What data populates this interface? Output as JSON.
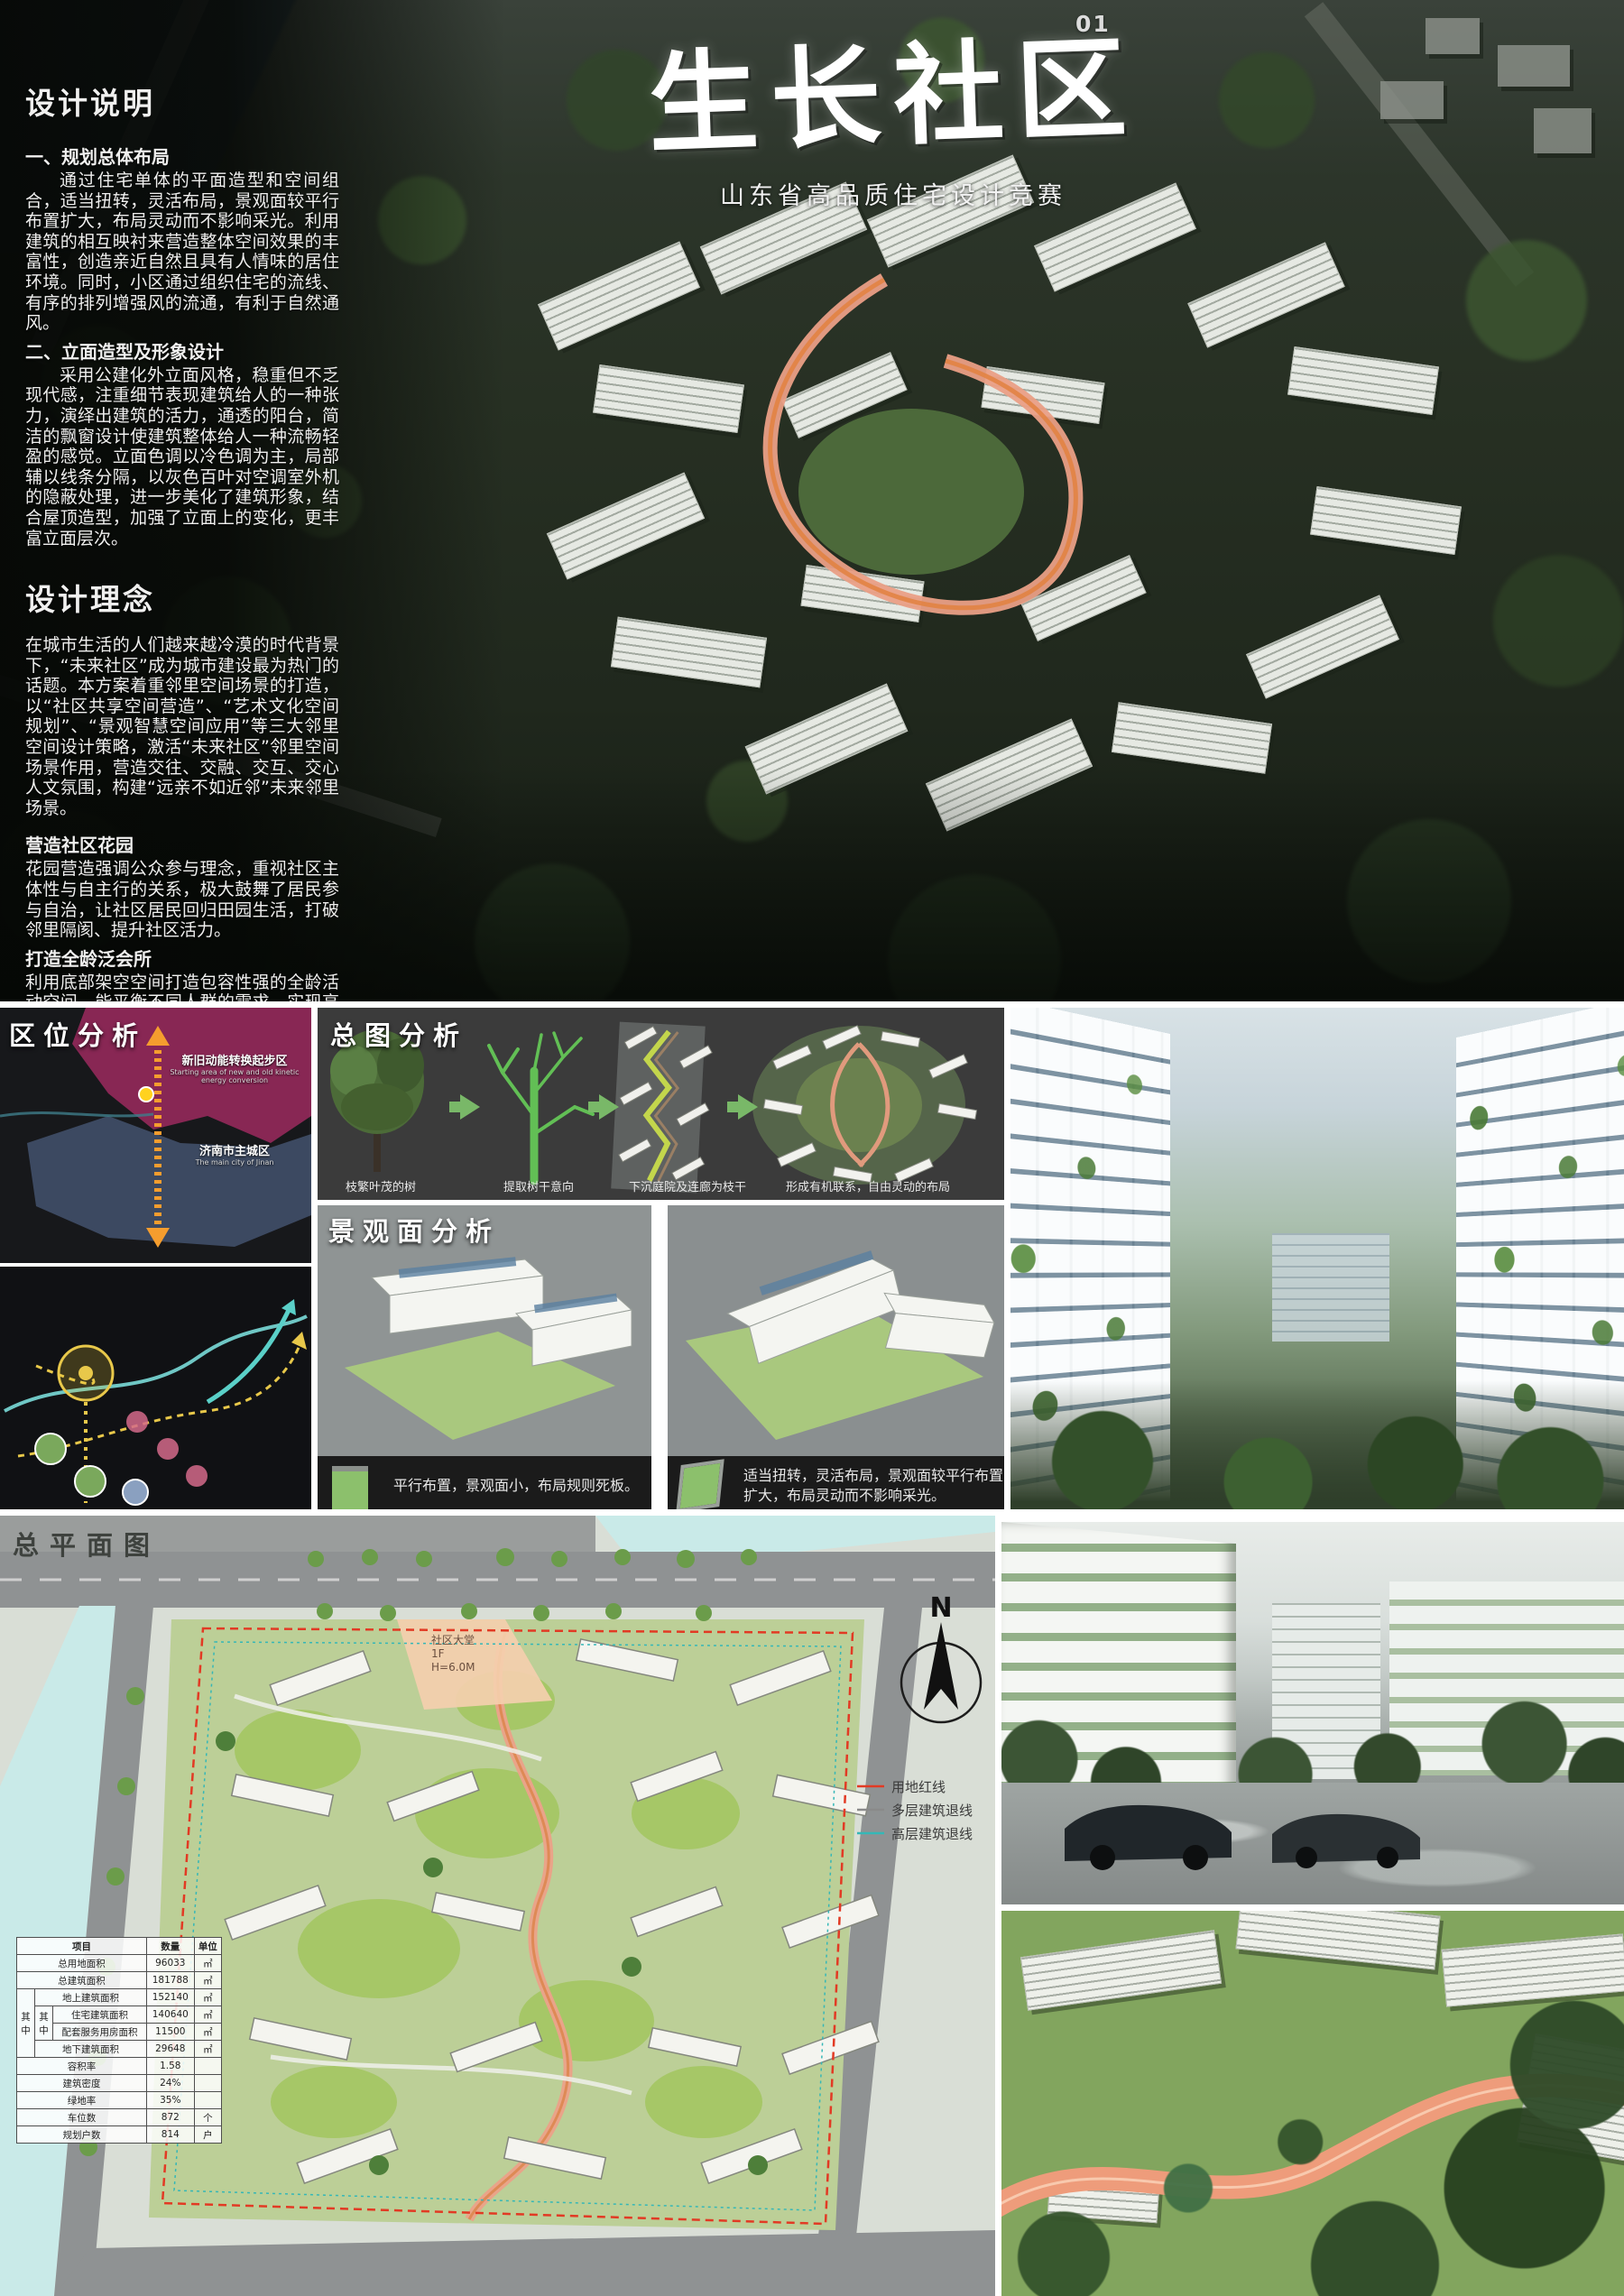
{
  "page": {
    "number": "01",
    "title": "生长社区",
    "subtitle": "山东省高品质住宅设计竞赛"
  },
  "design_notes": {
    "heading": "设计说明",
    "section1_title": "一、规划总体布局",
    "section1_body": "通过住宅单体的平面造型和空间组合，适当扭转，灵活布局，景观面较平行布置扩大，布局灵动而不影响采光。利用建筑的相互映衬来营造整体空间效果的丰富性，创造亲近自然且具有人情味的居住环境。同时，小区通过组织住宅的流线、有序的排列增强风的流通，有利于自然通风。",
    "section2_title": "二、立面造型及形象设计",
    "section2_body": "采用公建化外立面风格，稳重但不乏现代感，注重细节表现建筑给人的一种张力，演绎出建筑的活力，通透的阳台，简洁的飘窗设计使建筑整体给人一种流畅轻盈的感觉。立面色调以冷色调为主，局部辅以线条分隔，以灰色百叶对空调室外机的隐蔽处理，进一步美化了建筑形象，结合屋顶造型，加强了立面上的变化，更丰富立面层次。"
  },
  "design_concept": {
    "heading": "设计理念",
    "body": "在城市生活的人们越来越冷漠的时代背景下，“未来社区”成为城市建设最为热门的话题。本方案着重邻里空间场景的打造，以“社区共享空间营造”、“艺术文化空间规划”、“景观智慧空间应用”等三大邻里空间设计策略，激活“未来社区”邻里空间场景作用，营造交往、交融、交互、交心人文氛围，构建“远亲不如近邻”未来邻里场景。",
    "garden_title": "营造社区花园",
    "garden_body": "花园营造强调公众参与理念，重视社区主体性与自主行的关系，极大鼓舞了居民参与自治，让社区居民回归田园生活，打破邻里隔阂、提升社区活力。",
    "club_title": "打造全龄泛会所",
    "club_body": "利用底部架空空间打造包容性强的全龄活动空间，能平衡不同人群的需求，实现高参与度社区共享空间。"
  },
  "location_analysis": {
    "heading": "区位分析",
    "north_region_label": "新旧动能转换起步区",
    "north_region_sublabel": "Starting area of new and old kinetic energy conversion",
    "south_region_label": "济南市主城区",
    "south_region_sublabel": "The main city of Jinan"
  },
  "masterplan_analysis": {
    "heading": "总图分析",
    "steps": [
      {
        "caption": "枝繁叶茂的树"
      },
      {
        "caption": "提取树干意向"
      },
      {
        "caption": "下沉庭院及连廊为枝干"
      },
      {
        "caption": "形成有机联系，自由灵动的布局"
      }
    ]
  },
  "landscape_analysis": {
    "heading": "景观面分析",
    "panels": [
      {
        "caption": "平行布置，景观面小，布局规则死板。"
      },
      {
        "caption": "适当扭转，灵活布局，景观面较平行布置扩大，布局灵动而不影响采光。"
      }
    ]
  },
  "site_plan": {
    "heading": "总平面图",
    "north_label": "N",
    "legend": [
      {
        "label": "用地红线"
      },
      {
        "label": "多层建筑退线"
      },
      {
        "label": "高层建筑退线"
      }
    ],
    "lobby_line1": "社区大堂",
    "lobby_line2": "1F",
    "lobby_line3": "H=6.0M",
    "table": {
      "headers": {
        "item": "项目",
        "qty": "数量",
        "unit": "单位"
      },
      "group_label": "其中",
      "rows": [
        {
          "label": "总用地面积",
          "qty": "96033",
          "unit": "㎡"
        },
        {
          "label": "总建筑面积",
          "qty": "181788",
          "unit": "㎡"
        },
        {
          "label": "地上建筑面积",
          "qty": "152140",
          "unit": "㎡"
        },
        {
          "label": "住宅建筑面积",
          "qty": "140640",
          "unit": "㎡"
        },
        {
          "label": "配套服务用房面积",
          "qty": "11500",
          "unit": "㎡"
        },
        {
          "label": "地下建筑面积",
          "qty": "29648",
          "unit": "㎡"
        },
        {
          "label": "容积率",
          "qty": "1.58",
          "unit": ""
        },
        {
          "label": "建筑密度",
          "qty": "24%",
          "unit": ""
        },
        {
          "label": "绿地率",
          "qty": "35%",
          "unit": ""
        },
        {
          "label": "车位数",
          "qty": "872",
          "unit": "个"
        },
        {
          "label": "规划户数",
          "qty": "814",
          "unit": "户"
        }
      ]
    }
  },
  "colors": {
    "accent_salmon": "#ef9d7d",
    "magenta_zone": "#9c2a5e",
    "blue_zone": "#49597a",
    "green_arrow": "#79b868",
    "red_boundary": "#e23a24"
  }
}
